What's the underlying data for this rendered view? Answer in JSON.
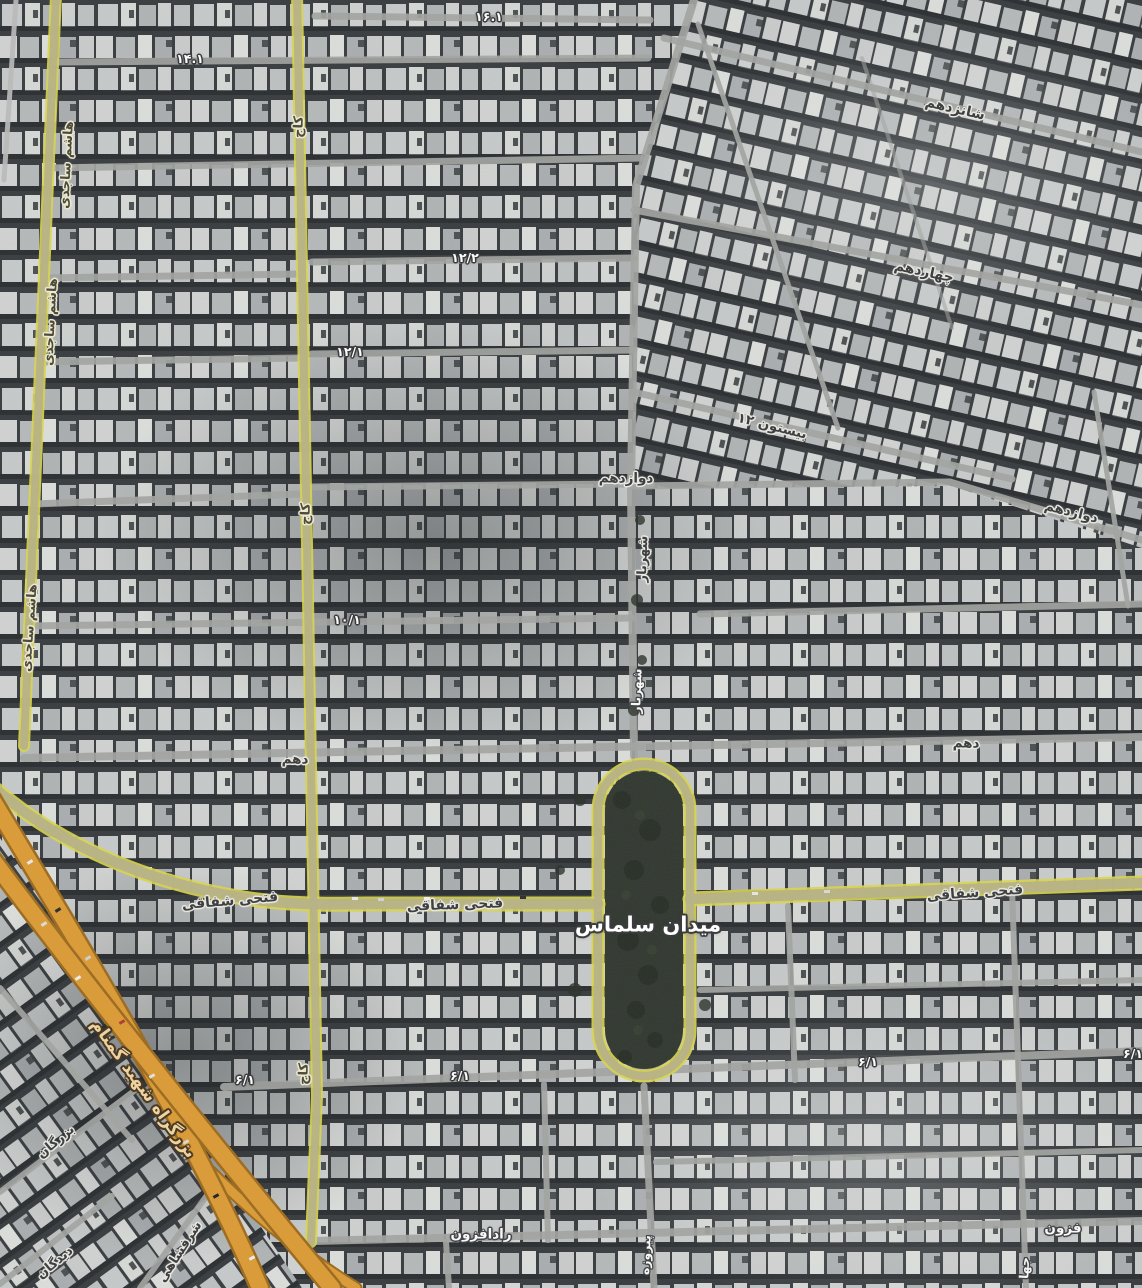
{
  "map": {
    "view_type": "satellite",
    "colors": {
      "satellite_base": "#383c3f",
      "building_light": "#cdd0cf",
      "street_gray": "#a2a4a1",
      "collector_fill": "#b7b286",
      "collector_edge": "#d9d54b",
      "highway_fill": "#db9b35",
      "highway_casing": "#9c6a1e",
      "park_fill": "#313830",
      "label_dark": "#3f4042",
      "label_white": "#fcfcfc",
      "label_highway": "#eed3a0"
    },
    "label_styles": {
      "dark": "dark text with light halo (minor street names)",
      "white": "white text with dark halo (numbered alleys)",
      "white-lg": "large white text (square name)",
      "white-sm": "small white vertical street names",
      "road-olive": "dark text with cream halo on olive collector roads",
      "highway": "tan text with dark halo along expressway"
    },
    "labels": [
      {
        "id": "hashem-sajedi-1",
        "text": "هاشم ساجدی",
        "style": "road-olive",
        "x": 67,
        "y": 165,
        "rot": -87,
        "size": 13
      },
      {
        "id": "hashem-sajedi-2",
        "text": "هاشم ساجدی",
        "style": "road-olive",
        "x": 51,
        "y": 322,
        "rot": -87,
        "size": 13
      },
      {
        "id": "hashem-sajedi-3",
        "text": "هاشم ساجدی",
        "style": "road-olive",
        "x": 30,
        "y": 628,
        "rot": -86,
        "size": 13
      },
      {
        "id": "kaj-1",
        "text": "کاج",
        "style": "road-olive",
        "x": 299,
        "y": 127,
        "rot": -88,
        "size": 13
      },
      {
        "id": "kaj-2",
        "text": "کاج",
        "style": "road-olive",
        "x": 306,
        "y": 514,
        "rot": -88,
        "size": 13
      },
      {
        "id": "kaj-3",
        "text": "کاج",
        "style": "road-olive",
        "x": 304,
        "y": 1074,
        "rot": -88,
        "size": 13
      },
      {
        "id": "num-14-1",
        "text": "۱۴.۱",
        "style": "white",
        "x": 190,
        "y": 59,
        "rot": 0,
        "size": 12.5
      },
      {
        "id": "num-16-1",
        "text": "۱۶.۱",
        "style": "white",
        "x": 489,
        "y": 17,
        "rot": 0,
        "size": 12.5
      },
      {
        "id": "shanzdahom",
        "text": "شانزدهم",
        "style": "dark",
        "x": 955,
        "y": 109,
        "rot": 13,
        "size": 14
      },
      {
        "id": "chahardahom",
        "text": "چهاردهم",
        "style": "dark",
        "x": 924,
        "y": 272,
        "rot": 12,
        "size": 14
      },
      {
        "id": "num-12-2",
        "text": "۱۲/۲",
        "style": "white",
        "x": 465,
        "y": 258,
        "rot": 0,
        "size": 12.5
      },
      {
        "id": "num-12-1",
        "text": "۱۲/۱",
        "style": "white",
        "x": 350,
        "y": 352,
        "rot": 0,
        "size": 12.5
      },
      {
        "id": "bisotun-12",
        "text": "بیستون ۱۲",
        "style": "dark",
        "x": 772,
        "y": 427,
        "rot": 14,
        "size": 13.5
      },
      {
        "id": "davazdahom-center",
        "text": "دوازدهم",
        "style": "dark",
        "x": 626,
        "y": 479,
        "rot": 0,
        "size": 13.5
      },
      {
        "id": "shahriar-upper",
        "text": "شهریار",
        "style": "dark",
        "x": 643,
        "y": 559,
        "rot": -88,
        "size": 13
      },
      {
        "id": "davazdahom-right",
        "text": "دوازدهم",
        "style": "dark",
        "x": 1071,
        "y": 513,
        "rot": 14,
        "size": 13.5
      },
      {
        "id": "num-10-1",
        "text": "۱۰/۱",
        "style": "white",
        "x": 347,
        "y": 620,
        "rot": 0,
        "size": 12.5
      },
      {
        "id": "shahriar-lower",
        "text": "شهریار",
        "style": "white-sm",
        "x": 637,
        "y": 691,
        "rot": -88,
        "size": 12.5
      },
      {
        "id": "dahom-left",
        "text": "دهم",
        "style": "dark",
        "x": 295,
        "y": 760,
        "rot": 0,
        "size": 13.5
      },
      {
        "id": "dahom-right",
        "text": "دهم",
        "style": "dark",
        "x": 966,
        "y": 744,
        "rot": 0,
        "size": 13.5
      },
      {
        "id": "fathi-shaghaghi-left",
        "text": "فتحی شفاقی",
        "style": "dark",
        "x": 230,
        "y": 901,
        "rot": -5,
        "size": 14
      },
      {
        "id": "fathi-shaghaghi-center",
        "text": "فتحی شفاقی",
        "style": "dark",
        "x": 455,
        "y": 905,
        "rot": -2,
        "size": 14
      },
      {
        "id": "fathi-shaghaghi-right",
        "text": "فتحی شفاقی",
        "style": "dark",
        "x": 975,
        "y": 893,
        "rot": -4,
        "size": 14
      },
      {
        "id": "meydan-salmas",
        "text": "میدان سلماس",
        "style": "white-lg",
        "x": 648,
        "y": 925,
        "rot": 0,
        "size": 21
      },
      {
        "id": "bozorgrah-shahid-gomnam",
        "text": "بزرگراه شهید گمنام",
        "style": "highway",
        "x": 143,
        "y": 1089,
        "rot": 54,
        "size": 17
      },
      {
        "id": "bozorgan",
        "text": "بزرگان",
        "style": "dark",
        "x": 56,
        "y": 1142,
        "rot": -40,
        "size": 13
      },
      {
        "id": "didegan",
        "text": "دیدگان",
        "style": "dark",
        "x": 55,
        "y": 1263,
        "rot": -40,
        "size": 13
      },
      {
        "id": "sharafshahi",
        "text": "شرفشاهی",
        "style": "dark",
        "x": 180,
        "y": 1252,
        "rot": -57,
        "size": 13
      },
      {
        "id": "num-6-1-a",
        "text": "۶/۱",
        "style": "white",
        "x": 245,
        "y": 1080,
        "rot": 0,
        "size": 12.5
      },
      {
        "id": "num-6-1-b",
        "text": "۶/۱",
        "style": "white",
        "x": 460,
        "y": 1076,
        "rot": 0,
        "size": 12.5
      },
      {
        "id": "num-6-1-c",
        "text": "۶/۱",
        "style": "white",
        "x": 868,
        "y": 1062,
        "rot": 0,
        "size": 12.5
      },
      {
        "id": "num-6-1-d",
        "text": "۶/۱",
        "style": "white",
        "x": 1133,
        "y": 1054,
        "rot": 0,
        "size": 12.5
      },
      {
        "id": "radafzoon",
        "text": "رادافزون",
        "style": "white-md",
        "x": 481,
        "y": 1235,
        "rot": 0,
        "size": 13.5
      },
      {
        "id": "fozoon-partial",
        "text": "فزون",
        "style": "white-md",
        "x": 1063,
        "y": 1229,
        "rot": 0,
        "size": 13.5
      },
      {
        "id": "pirouzeh",
        "text": "پیروزه",
        "style": "white-sm",
        "x": 646,
        "y": 1255,
        "rot": -87,
        "size": 12.5
      },
      {
        "id": "jaha-partial",
        "text": "جها",
        "style": "white-sm",
        "x": 1025,
        "y": 1268,
        "rot": -87,
        "size": 12.5
      }
    ]
  }
}
